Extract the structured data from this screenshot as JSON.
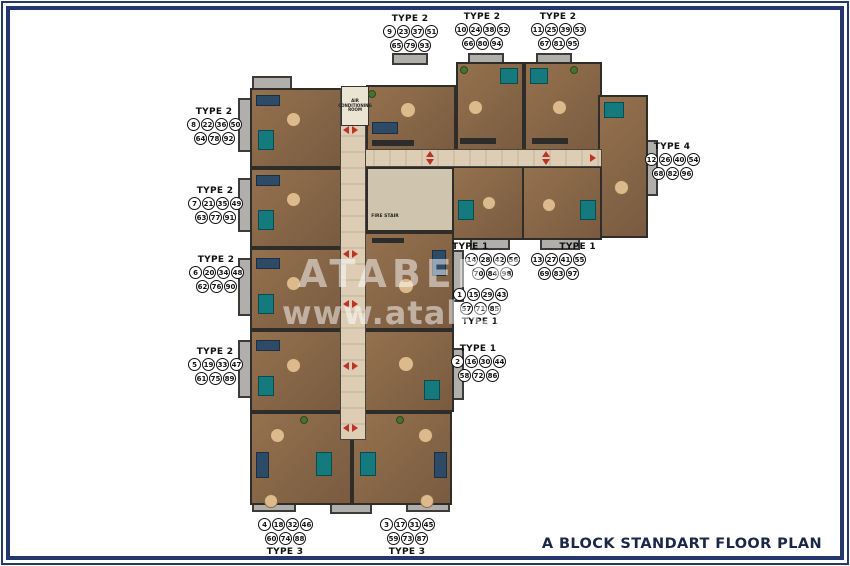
{
  "window": {
    "title": "A BLOCK STANDART FLOOR PLAN"
  },
  "watermark": {
    "line1": "ATABERK",
    "line2": "www.ataberke"
  },
  "colors": {
    "frame": "#24386b",
    "title_text": "#1b2747",
    "corridor": "#dccdb4",
    "unit_floor": "#8a684c",
    "balcony": "#b0afac",
    "bed_teal": "#157a7d",
    "sofa_navy": "#2d4a66",
    "arrow_red": "#bb3327"
  },
  "core_labels": {
    "air_conditioning_room": "AIR CONDITIONING ROOM",
    "elevator": "ELEVATOR",
    "fire_stair": "FIRE STAIR"
  },
  "unit_groups": [
    {
      "id": "top-1",
      "type_label": "TYPE 2",
      "rows": [
        [
          "9",
          "23",
          "37",
          "51"
        ],
        [
          "65",
          "79",
          "93"
        ]
      ]
    },
    {
      "id": "top-2",
      "type_label": "TYPE 2",
      "rows": [
        [
          "10",
          "24",
          "38",
          "52"
        ],
        [
          "66",
          "80",
          "94"
        ]
      ]
    },
    {
      "id": "top-3",
      "type_label": "TYPE 2",
      "rows": [
        [
          "11",
          "25",
          "39",
          "53"
        ],
        [
          "67",
          "81",
          "95"
        ]
      ]
    },
    {
      "id": "left-1",
      "type_label": "TYPE 2",
      "rows": [
        [
          "8",
          "22",
          "36",
          "50"
        ],
        [
          "64",
          "78",
          "92"
        ]
      ]
    },
    {
      "id": "left-2",
      "type_label": "TYPE 2",
      "rows": [
        [
          "7",
          "21",
          "35",
          "49"
        ],
        [
          "63",
          "77",
          "91"
        ]
      ]
    },
    {
      "id": "left-3",
      "type_label": "TYPE 2",
      "rows": [
        [
          "6",
          "20",
          "34",
          "48"
        ],
        [
          "62",
          "76",
          "90"
        ]
      ]
    },
    {
      "id": "left-4",
      "type_label": "TYPE 2",
      "rows": [
        [
          "5",
          "19",
          "33",
          "47"
        ],
        [
          "61",
          "75",
          "89"
        ]
      ]
    },
    {
      "id": "right-type4",
      "type_label": "TYPE 4",
      "rows": [
        [
          "12",
          "26",
          "40",
          "54"
        ],
        [
          "68",
          "82",
          "96"
        ]
      ]
    },
    {
      "id": "mid-type1-left",
      "type_label": "TYPE 1",
      "rows": [
        [
          "14",
          "28",
          "42",
          "56"
        ],
        [
          "70",
          "84",
          "98"
        ]
      ]
    },
    {
      "id": "mid-type1-right",
      "type_label": "TYPE 1",
      "rows": [
        [
          "13",
          "27",
          "41",
          "55"
        ],
        [
          "69",
          "83",
          "97"
        ]
      ]
    },
    {
      "id": "center-type1",
      "type_label": "TYPE 1",
      "rows": [
        [
          "1",
          "15",
          "29",
          "43"
        ],
        [
          "57",
          "71",
          "85"
        ]
      ]
    },
    {
      "id": "lower-type1",
      "type_label": "TYPE 1",
      "rows": [
        [
          "2",
          "16",
          "30",
          "44"
        ],
        [
          "58",
          "72",
          "86"
        ]
      ]
    },
    {
      "id": "bottom-type3-left",
      "type_label": "TYPE 3",
      "rows": [
        [
          "4",
          "18",
          "32",
          "46"
        ],
        [
          "60",
          "74",
          "88"
        ]
      ]
    },
    {
      "id": "bottom-type3-right",
      "type_label": "TYPE 3",
      "rows": [
        [
          "3",
          "17",
          "31",
          "45"
        ],
        [
          "59",
          "73",
          "87"
        ]
      ]
    }
  ]
}
